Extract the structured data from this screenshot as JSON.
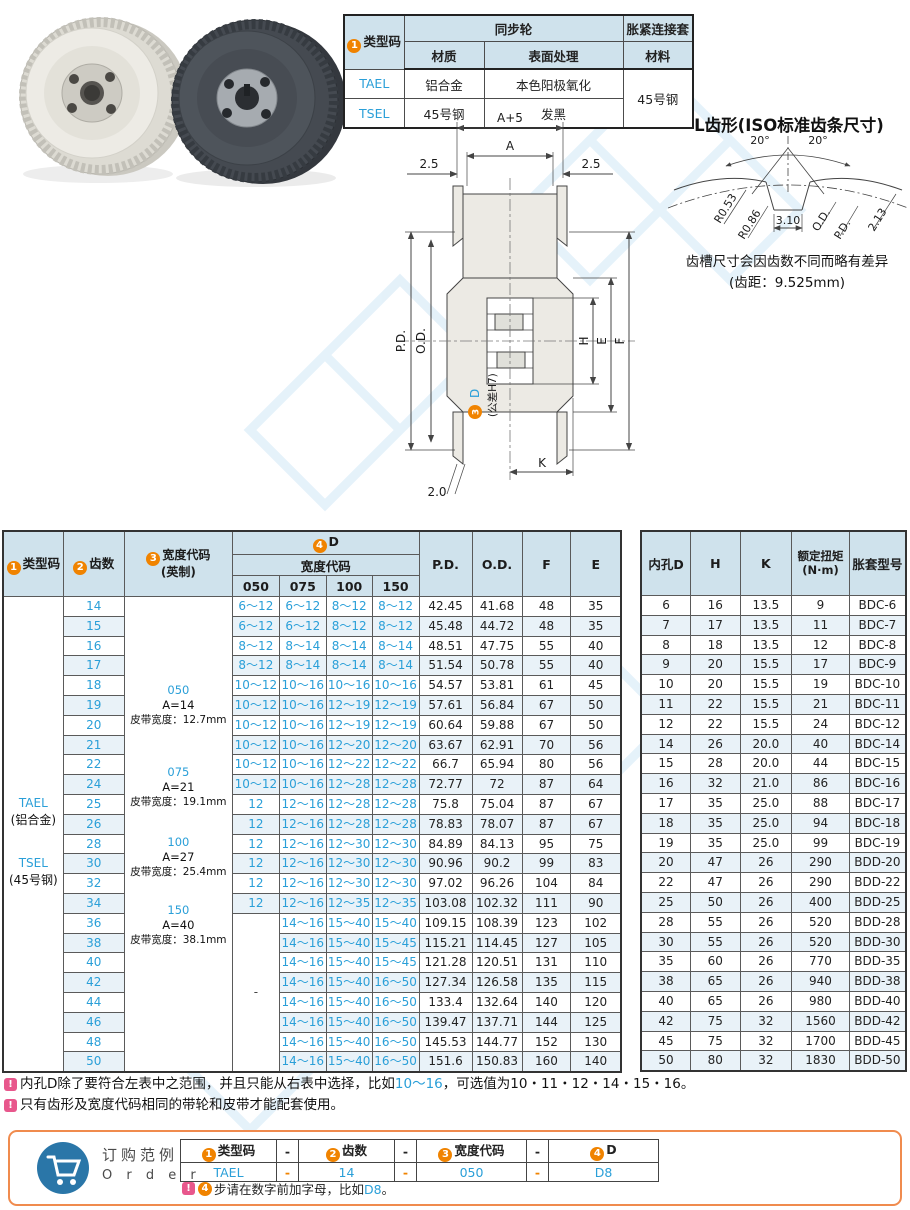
{
  "colors": {
    "blue": "#2a9fd8",
    "orange": "#f08300",
    "pink": "#e8578c",
    "header_bg": "#cfe2ec",
    "order_border": "#f08b4e"
  },
  "badges": {
    "b1": "1",
    "b2": "2",
    "b3": "3",
    "b4": "4"
  },
  "top_table": {
    "col_type": "类型码",
    "grp_sync": "同步轮",
    "grp_sleeve": "胀紧连接套",
    "sub_material": "材质",
    "sub_surface": "表面处理",
    "sub_sleeve_material": "材料",
    "rows": [
      {
        "code": "TAEL",
        "mat": "铝合金",
        "surf": "本色阳极氧化"
      },
      {
        "code": "TSEL",
        "mat": "45号钢",
        "surf": "发黑"
      }
    ],
    "sleeve_mat": "45号钢"
  },
  "tooth_profile": {
    "title": "L齿形(ISO标准齿条尺寸)",
    "angle_left": "20°",
    "angle_right": "20°",
    "r1": "R0.53",
    "r2": "R0.86",
    "w": "3.10",
    "od": "O.D.",
    "pd": "P.D.",
    "depth": "2.13",
    "note1": "齿槽尺寸会因齿数不同而略有差异",
    "note2": "(齿距：9.525mm)"
  },
  "drawing": {
    "dim_a5": "A+5",
    "dim_a": "A",
    "dim_25_left": "2.5",
    "dim_25_right": "2.5",
    "dim_pd": "P.D.",
    "dim_od": "O.D.",
    "dim_d_badge": "3",
    "dim_d": "D",
    "dim_d_tol": "(公差H7)",
    "dim_h": "H",
    "dim_e": "E",
    "dim_f": "F",
    "dim_k": "K",
    "dim_20": "2.0"
  },
  "main_table": {
    "headers": {
      "type": "类型码",
      "teeth": "齿数",
      "width": "宽度代码",
      "width2": "(英制)",
      "d": "D",
      "width_code": "宽度代码",
      "w050": "050",
      "w075": "075",
      "w100": "100",
      "w150": "150",
      "pd": "P.D.",
      "od": "O.D.",
      "f": "F",
      "e": "E",
      "bore": "内孔D",
      "h": "H",
      "k": "K",
      "torque": "额定扭矩",
      "torque2": "(N·m)",
      "sleeve": "胀套型号"
    },
    "type_code_lines": {
      "c1": "TAEL",
      "m1": "(铝合金)",
      "c2": "TSEL",
      "m2": "(45号钢)"
    },
    "width_blocks": [
      {
        "code": "050",
        "a": "A=14",
        "belt": "皮带宽度：12.7mm"
      },
      {
        "code": "075",
        "a": "A=21",
        "belt": "皮带宽度：19.1mm"
      },
      {
        "code": "100",
        "a": "A=27",
        "belt": "皮带宽度：25.4mm"
      },
      {
        "code": "150",
        "a": "A=40",
        "belt": "皮带宽度：38.1mm"
      }
    ],
    "dash": "-",
    "rows": [
      {
        "t": "14",
        "d0": "6～12",
        "d1": "6～12",
        "d2": "8～12",
        "d3": "8～12",
        "pd": "42.45",
        "od": "41.68",
        "f": "48",
        "e": "35",
        "b": "6",
        "h": "16",
        "k": "13.5",
        "tq": "9",
        "sl": "BDC-6"
      },
      {
        "t": "15",
        "d0": "6～12",
        "d1": "6～12",
        "d2": "8～12",
        "d3": "8～12",
        "pd": "45.48",
        "od": "44.72",
        "f": "48",
        "e": "35",
        "b": "7",
        "h": "17",
        "k": "13.5",
        "tq": "11",
        "sl": "BDC-7"
      },
      {
        "t": "16",
        "d0": "8～12",
        "d1": "8～14",
        "d2": "8～14",
        "d3": "8～14",
        "pd": "48.51",
        "od": "47.75",
        "f": "55",
        "e": "40",
        "b": "8",
        "h": "18",
        "k": "13.5",
        "tq": "12",
        "sl": "BDC-8"
      },
      {
        "t": "17",
        "d0": "8～12",
        "d1": "8～14",
        "d2": "8～14",
        "d3": "8～14",
        "pd": "51.54",
        "od": "50.78",
        "f": "55",
        "e": "40",
        "b": "9",
        "h": "20",
        "k": "15.5",
        "tq": "17",
        "sl": "BDC-9"
      },
      {
        "t": "18",
        "d0": "10～12",
        "d1": "10～16",
        "d2": "10～16",
        "d3": "10～16",
        "pd": "54.57",
        "od": "53.81",
        "f": "61",
        "e": "45",
        "b": "10",
        "h": "20",
        "k": "15.5",
        "tq": "19",
        "sl": "BDC-10"
      },
      {
        "t": "19",
        "d0": "10～12",
        "d1": "10～16",
        "d2": "12～19",
        "d3": "12～19",
        "pd": "57.61",
        "od": "56.84",
        "f": "67",
        "e": "50",
        "b": "11",
        "h": "22",
        "k": "15.5",
        "tq": "21",
        "sl": "BDC-11"
      },
      {
        "t": "20",
        "d0": "10～12",
        "d1": "10～16",
        "d2": "12～19",
        "d3": "12～19",
        "pd": "60.64",
        "od": "59.88",
        "f": "67",
        "e": "50",
        "b": "12",
        "h": "22",
        "k": "15.5",
        "tq": "24",
        "sl": "BDC-12"
      },
      {
        "t": "21",
        "d0": "10～12",
        "d1": "10～16",
        "d2": "12～20",
        "d3": "12～20",
        "pd": "63.67",
        "od": "62.91",
        "f": "70",
        "e": "56",
        "b": "14",
        "h": "26",
        "k": "20.0",
        "tq": "40",
        "sl": "BDC-14"
      },
      {
        "t": "22",
        "d0": "10～12",
        "d1": "10～16",
        "d2": "12～22",
        "d3": "12～22",
        "pd": "66.7",
        "od": "65.94",
        "f": "80",
        "e": "56",
        "b": "15",
        "h": "28",
        "k": "20.0",
        "tq": "44",
        "sl": "BDC-15"
      },
      {
        "t": "24",
        "d0": "10～12",
        "d1": "10～16",
        "d2": "12～28",
        "d3": "12～28",
        "pd": "72.77",
        "od": "72",
        "f": "87",
        "e": "64",
        "b": "16",
        "h": "32",
        "k": "21.0",
        "tq": "86",
        "sl": "BDC-16"
      },
      {
        "t": "25",
        "d0": "12",
        "d1": "12～16",
        "d2": "12～28",
        "d3": "12～28",
        "pd": "75.8",
        "od": "75.04",
        "f": "87",
        "e": "67",
        "b": "17",
        "h": "35",
        "k": "25.0",
        "tq": "88",
        "sl": "BDC-17"
      },
      {
        "t": "26",
        "d0": "12",
        "d1": "12～16",
        "d2": "12～28",
        "d3": "12～28",
        "pd": "78.83",
        "od": "78.07",
        "f": "87",
        "e": "67",
        "b": "18",
        "h": "35",
        "k": "25.0",
        "tq": "94",
        "sl": "BDC-18"
      },
      {
        "t": "28",
        "d0": "12",
        "d1": "12～16",
        "d2": "12～30",
        "d3": "12～30",
        "pd": "84.89",
        "od": "84.13",
        "f": "95",
        "e": "75",
        "b": "19",
        "h": "35",
        "k": "25.0",
        "tq": "99",
        "sl": "BDC-19"
      },
      {
        "t": "30",
        "d0": "12",
        "d1": "12～16",
        "d2": "12～30",
        "d3": "12～30",
        "pd": "90.96",
        "od": "90.2",
        "f": "99",
        "e": "83",
        "b": "20",
        "h": "47",
        "k": "26",
        "tq": "290",
        "sl": "BDD-20"
      },
      {
        "t": "32",
        "d0": "12",
        "d1": "12～16",
        "d2": "12～30",
        "d3": "12～30",
        "pd": "97.02",
        "od": "96.26",
        "f": "104",
        "e": "84",
        "b": "22",
        "h": "47",
        "k": "26",
        "tq": "290",
        "sl": "BDD-22"
      },
      {
        "t": "34",
        "d0": "12",
        "d1": "12～16",
        "d2": "12～35",
        "d3": "12～35",
        "pd": "103.08",
        "od": "102.32",
        "f": "111",
        "e": "90",
        "b": "25",
        "h": "50",
        "k": "26",
        "tq": "400",
        "sl": "BDD-25"
      },
      {
        "t": "36",
        "d0": null,
        "d1": "14～16",
        "d2": "15～40",
        "d3": "15～40",
        "pd": "109.15",
        "od": "108.39",
        "f": "123",
        "e": "102",
        "b": "28",
        "h": "55",
        "k": "26",
        "tq": "520",
        "sl": "BDD-28"
      },
      {
        "t": "38",
        "d0": null,
        "d1": "14～16",
        "d2": "15～40",
        "d3": "15～45",
        "pd": "115.21",
        "od": "114.45",
        "f": "127",
        "e": "105",
        "b": "30",
        "h": "55",
        "k": "26",
        "tq": "520",
        "sl": "BDD-30"
      },
      {
        "t": "40",
        "d0": null,
        "d1": "14～16",
        "d2": "15～40",
        "d3": "15～45",
        "pd": "121.28",
        "od": "120.51",
        "f": "131",
        "e": "110",
        "b": "35",
        "h": "60",
        "k": "26",
        "tq": "770",
        "sl": "BDD-35"
      },
      {
        "t": "42",
        "d0": null,
        "d1": "14～16",
        "d2": "15～40",
        "d3": "16～50",
        "pd": "127.34",
        "od": "126.58",
        "f": "135",
        "e": "115",
        "b": "38",
        "h": "65",
        "k": "26",
        "tq": "940",
        "sl": "BDD-38"
      },
      {
        "t": "44",
        "d0": null,
        "d1": "14～16",
        "d2": "15～40",
        "d3": "16～50",
        "pd": "133.4",
        "od": "132.64",
        "f": "140",
        "e": "120",
        "b": "40",
        "h": "65",
        "k": "26",
        "tq": "980",
        "sl": "BDD-40"
      },
      {
        "t": "46",
        "d0": null,
        "d1": "14～16",
        "d2": "15～40",
        "d3": "16～50",
        "pd": "139.47",
        "od": "137.71",
        "f": "144",
        "e": "125",
        "b": "42",
        "h": "75",
        "k": "32",
        "tq": "1560",
        "sl": "BDD-42"
      },
      {
        "t": "48",
        "d0": null,
        "d1": "14～16",
        "d2": "15～40",
        "d3": "16～50",
        "pd": "145.53",
        "od": "144.77",
        "f": "152",
        "e": "130",
        "b": "45",
        "h": "75",
        "k": "32",
        "tq": "1700",
        "sl": "BDD-45"
      },
      {
        "t": "50",
        "d0": null,
        "d1": "14～16",
        "d2": "15～40",
        "d3": "16～50",
        "pd": "151.6",
        "od": "150.83",
        "f": "160",
        "e": "140",
        "b": "50",
        "h": "80",
        "k": "32",
        "tq": "1830",
        "sl": "BDD-50"
      }
    ]
  },
  "notes": {
    "n1_pre": "内孔D除了要符合左表中之范围，并且只能从右表中选择，比如",
    "n1_hl": "10～16",
    "n1_post": "，可选值为10・11・12・14・15・16。",
    "n2": "只有齿形及宽度代码相同的带轮和皮带才能配套使用。"
  },
  "order": {
    "title_cn": "订购范例",
    "title_en": "O r d e r",
    "h1": "类型码",
    "h2": "齿数",
    "h3": "宽度代码",
    "h4": "D",
    "v1": "TAEL",
    "v2": "14",
    "v3": "050",
    "v4": "D8",
    "dash": "-",
    "note_pre": "步请在数字前加字母，比如",
    "note_hl": "D8",
    "note_post": "。"
  }
}
